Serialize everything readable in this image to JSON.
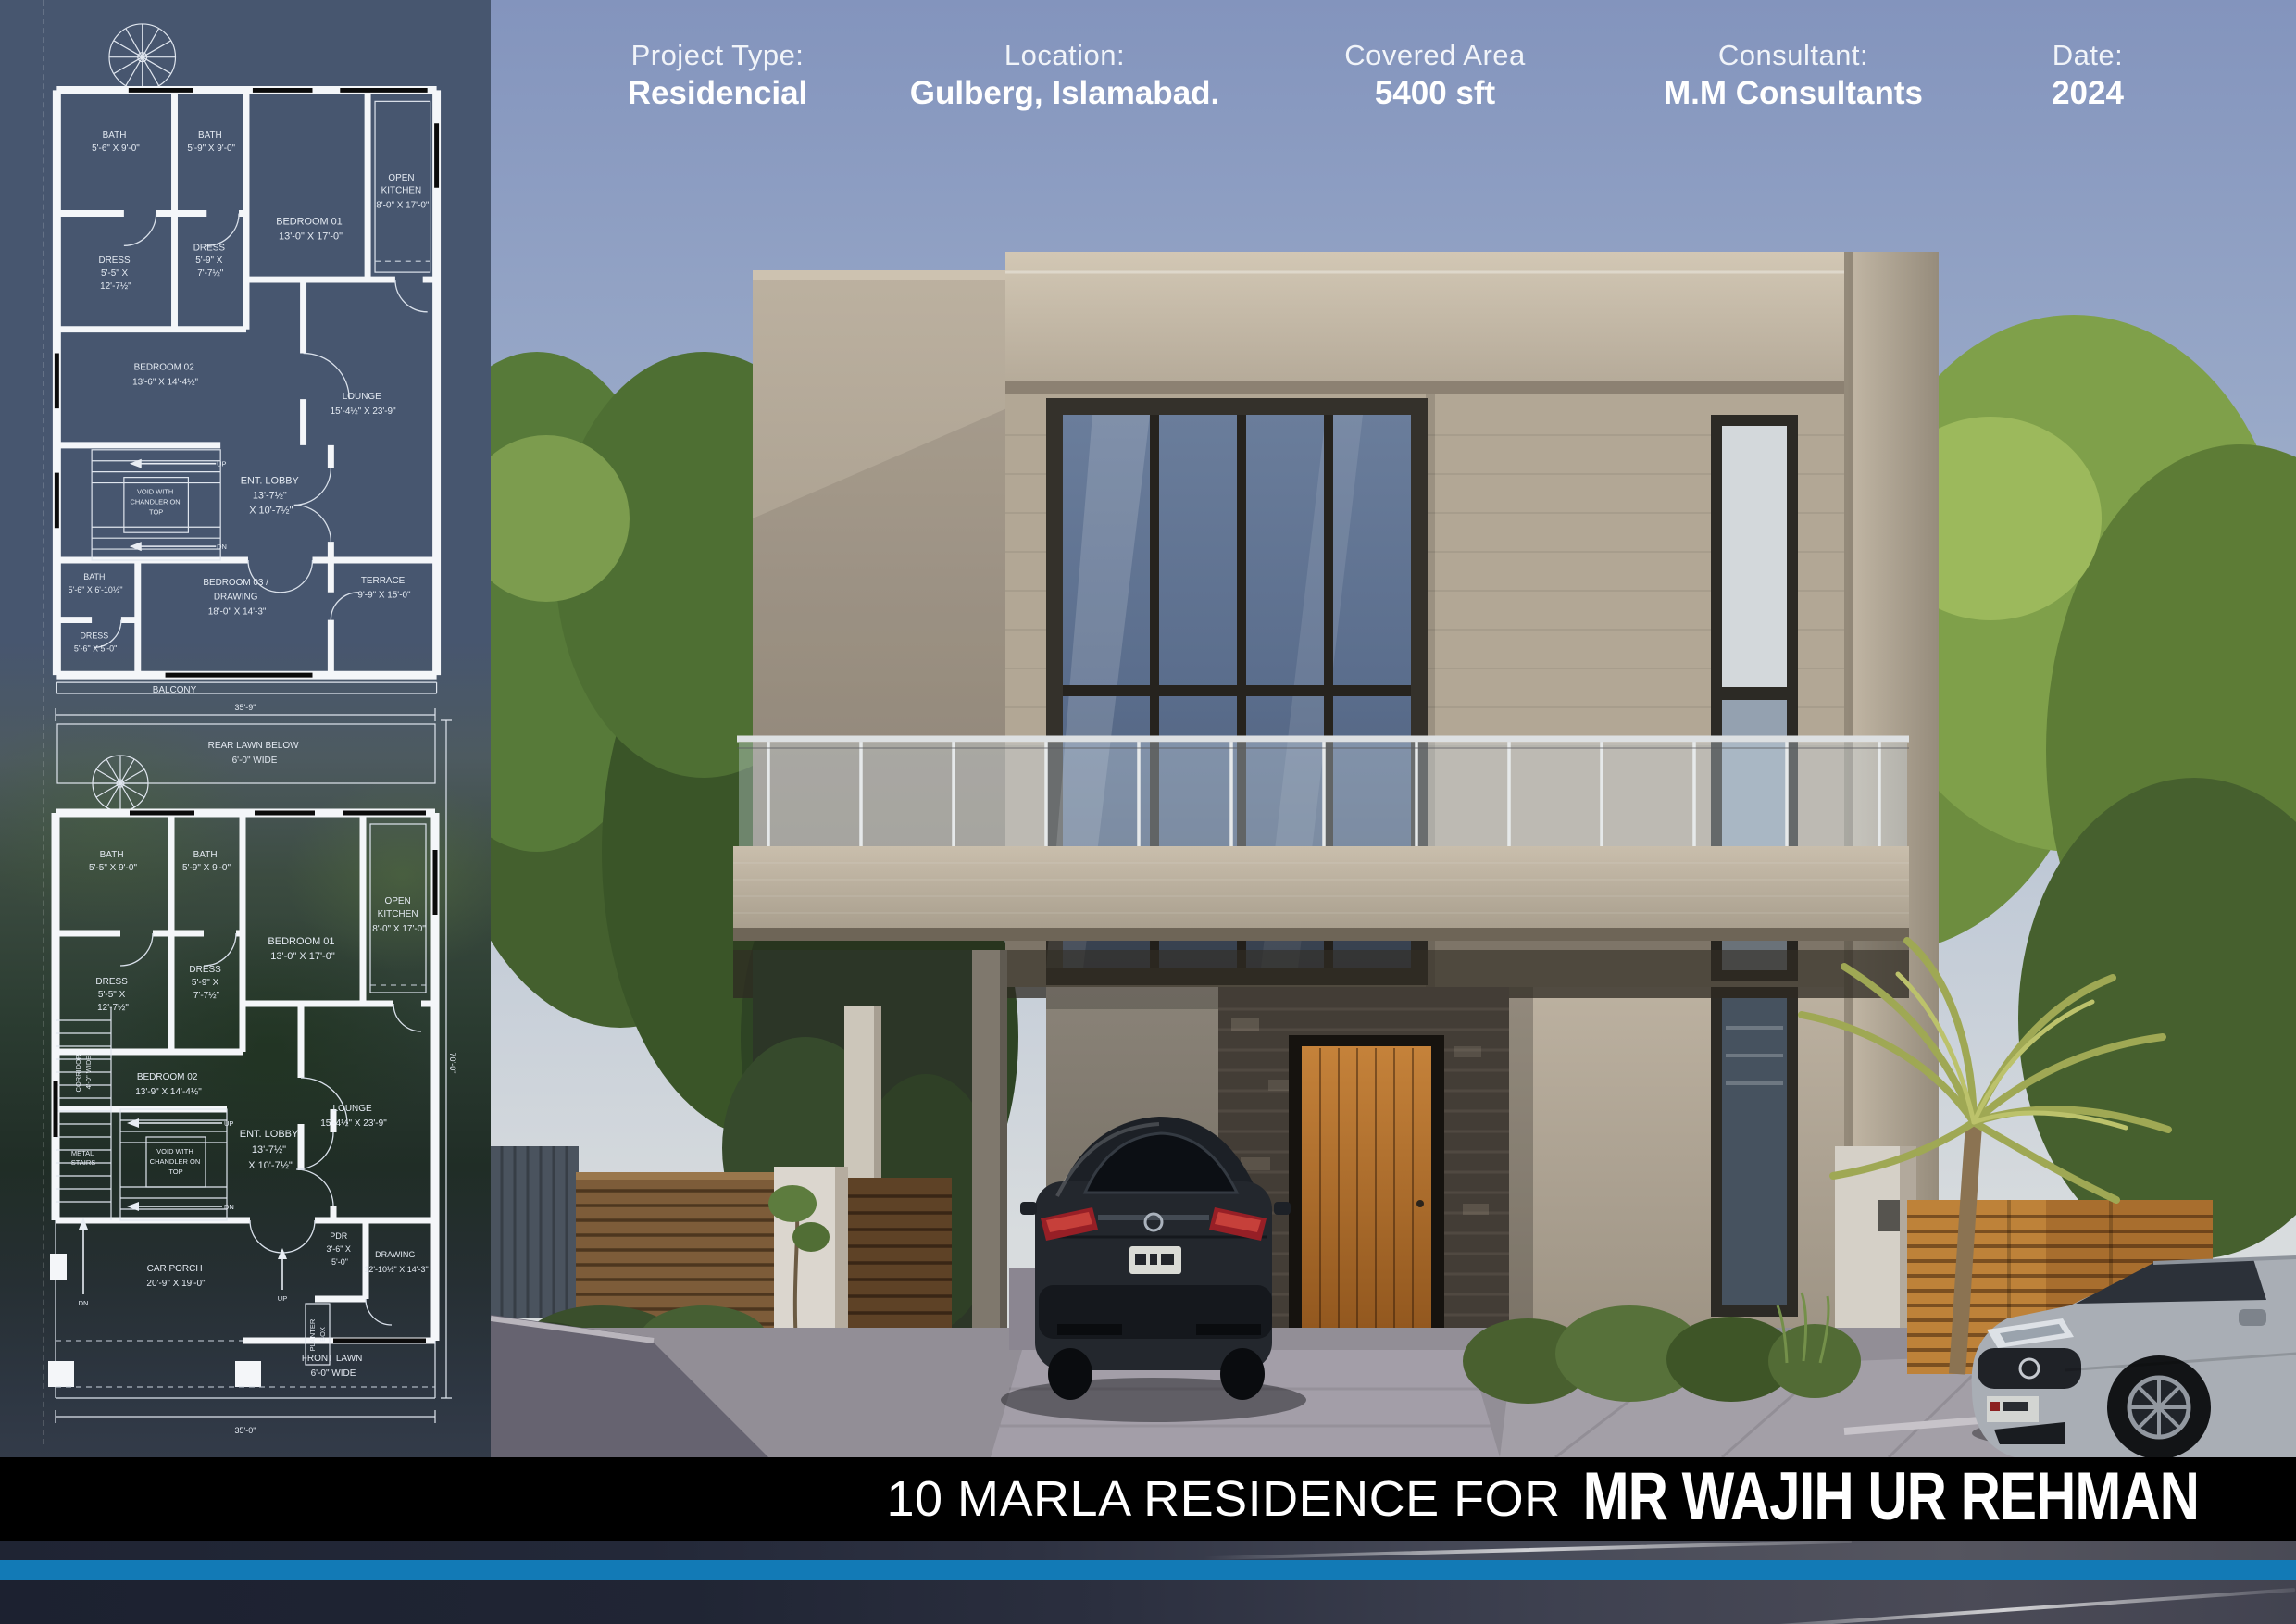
{
  "header": {
    "columns": [
      {
        "label": "Project Type:",
        "value": "Residencial"
      },
      {
        "label": "Location:",
        "value": "Gulberg, Islamabad."
      },
      {
        "label": "Covered Area",
        "value": "5400 sft"
      },
      {
        "label": "Consultant:",
        "value": "M.M Consultants"
      },
      {
        "label": "Date:",
        "value": "2024"
      }
    ]
  },
  "footer": {
    "title_prefix": "10 MARLA RESIDENCE FOR",
    "client_name": "MR WAJIH UR REHMAN"
  },
  "colors": {
    "accent_stripe": "#127AB6",
    "title_bar": "#000000",
    "sidebar_slate": "#47566F",
    "sky_top": "#8394BD"
  },
  "plans": {
    "annotations": {
      "up": "UP",
      "dn": "DN"
    },
    "first_floor": {
      "labels": {
        "bath_a": [
          "BATH",
          "5'-6\" X 9'-0\""
        ],
        "bath_b": [
          "BATH",
          "5'-9\" X 9'-0\""
        ],
        "bedroom1": [
          "BEDROOM 01",
          "13'-0\" X 17'-0\""
        ],
        "kitchen": [
          "OPEN",
          "KITCHEN",
          "8'-0\" X 17'-0\""
        ],
        "dress_a": [
          "DRESS",
          "5'-5\" X",
          "12'-7½\""
        ],
        "dress_b": [
          "DRESS",
          "5'-9\" X",
          "7'-7½\""
        ],
        "bedroom2": [
          "BEDROOM 02",
          "13'-6\" X 14'-4½\""
        ],
        "lounge": [
          "LOUNGE",
          "15'-4½\" X 23'-9\""
        ],
        "void": [
          "VOID WITH",
          "CHANDLER ON",
          "TOP"
        ],
        "lobby": [
          "ENT. LOBBY",
          "13'-7½\"",
          "X 10'-7½\""
        ],
        "bath_c": [
          "BATH",
          "5'-6\" X 6'-10½\""
        ],
        "dress_c": [
          "DRESS",
          "5'-6\" X 5'-0\""
        ],
        "bedroom3": [
          "BEDROOM 03 /",
          "DRAWING",
          "18'-0\" X 14'-3\""
        ],
        "terrace": [
          "TERRACE",
          "9'-9\" X 15'-0\""
        ],
        "balcony": [
          "BALCONY"
        ]
      }
    },
    "ground_floor": {
      "dimensions": {
        "top": "35'-9\"",
        "bottom": "35'-0\"",
        "right": "70'-0\""
      },
      "labels": {
        "rear_lawn": [
          "REAR LAWN BELOW",
          "6'-0\" WIDE"
        ],
        "bath_a": [
          "BATH",
          "5'-5\" X 9'-0\""
        ],
        "bath_b": [
          "BATH",
          "5'-9\" X 9'-0\""
        ],
        "bedroom1": [
          "BEDROOM 01",
          "13'-0\" X 17'-0\""
        ],
        "kitchen": [
          "OPEN",
          "KITCHEN",
          "8'-0\" X 17'-0\""
        ],
        "dress_a": [
          "DRESS",
          "5'-5\" X",
          "12'-7½\""
        ],
        "dress_b": [
          "DRESS",
          "5'-9\" X",
          "7'-7½\""
        ],
        "corridor": [
          "CORRIDOR",
          "4'-0\" WIDE"
        ],
        "metal_stairs": [
          "METAL",
          "STAIRS"
        ],
        "bedroom2": [
          "BEDROOM 02",
          "13'-9\" X 14'-4½\""
        ],
        "lounge": [
          "LOUNGE",
          "15'-4½\" X 23'-9\""
        ],
        "void": [
          "VOID WITH",
          "CHANDLER ON",
          "TOP"
        ],
        "lobby": [
          "ENT. LOBBY",
          "13'-7½\"",
          "X 10'-7½\""
        ],
        "pdr": [
          "PDR",
          "3'-6\" X",
          "5'-0\""
        ],
        "planter": [
          "PLANTER",
          "BOX"
        ],
        "drawing": [
          "DRAWING",
          "12'-10½\" X 14'-3\""
        ],
        "car_porch": [
          "CAR PORCH",
          "20'-9\" X 19'-0\""
        ],
        "front_lawn": [
          "FRONT LAWN",
          "6'-0\" WIDE"
        ]
      }
    }
  }
}
